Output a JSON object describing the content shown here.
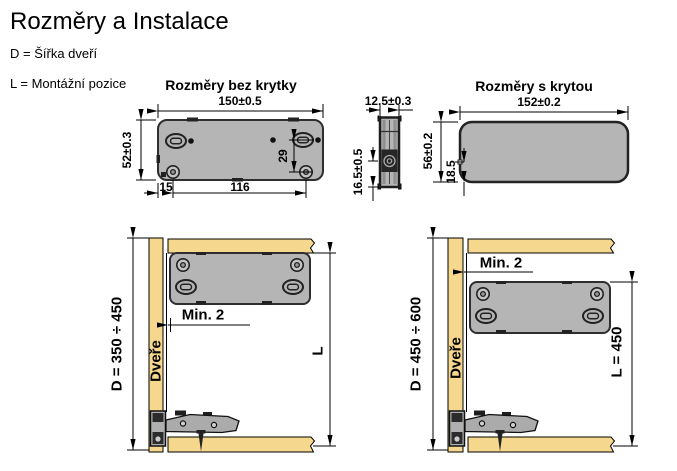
{
  "page": {
    "title": "Rozměry a Instalace",
    "legend": {
      "d_definition": "D = Šířka dveří",
      "l_definition": "L = Montážní pozice"
    }
  },
  "views": {
    "without_cover": {
      "title": "Rozměry bez krytky",
      "dims": {
        "width": "150±0.5",
        "height": "52±0.3",
        "slot_to_hole": "29",
        "edge_to_hole": "15",
        "hole_spacing": "116"
      }
    },
    "side": {
      "dims": {
        "width": "12.5±0.3",
        "screw_from_bottom": "16.5±0.5"
      }
    },
    "with_cover": {
      "title": "Rozměry s krytou",
      "dims": {
        "width": "152±0.2",
        "height": "56±0.2",
        "bottom_offset": "18.5"
      }
    }
  },
  "installation": {
    "small_door": {
      "door_range": "D = 350 ÷ 450",
      "door_label": "Dveře",
      "min_gap": "Min. 2",
      "mounting_position": "L"
    },
    "large_door": {
      "door_range": "D = 450 ÷ 600",
      "door_label": "Dveře",
      "min_gap": "Min. 2",
      "mounting_position": "L = 450"
    }
  },
  "colors": {
    "wood": "#f5d78e",
    "device_fill": "#b5b5b5",
    "device_stroke": "#2e2e2e",
    "line": "#000000",
    "dark_detail": "#222222"
  }
}
